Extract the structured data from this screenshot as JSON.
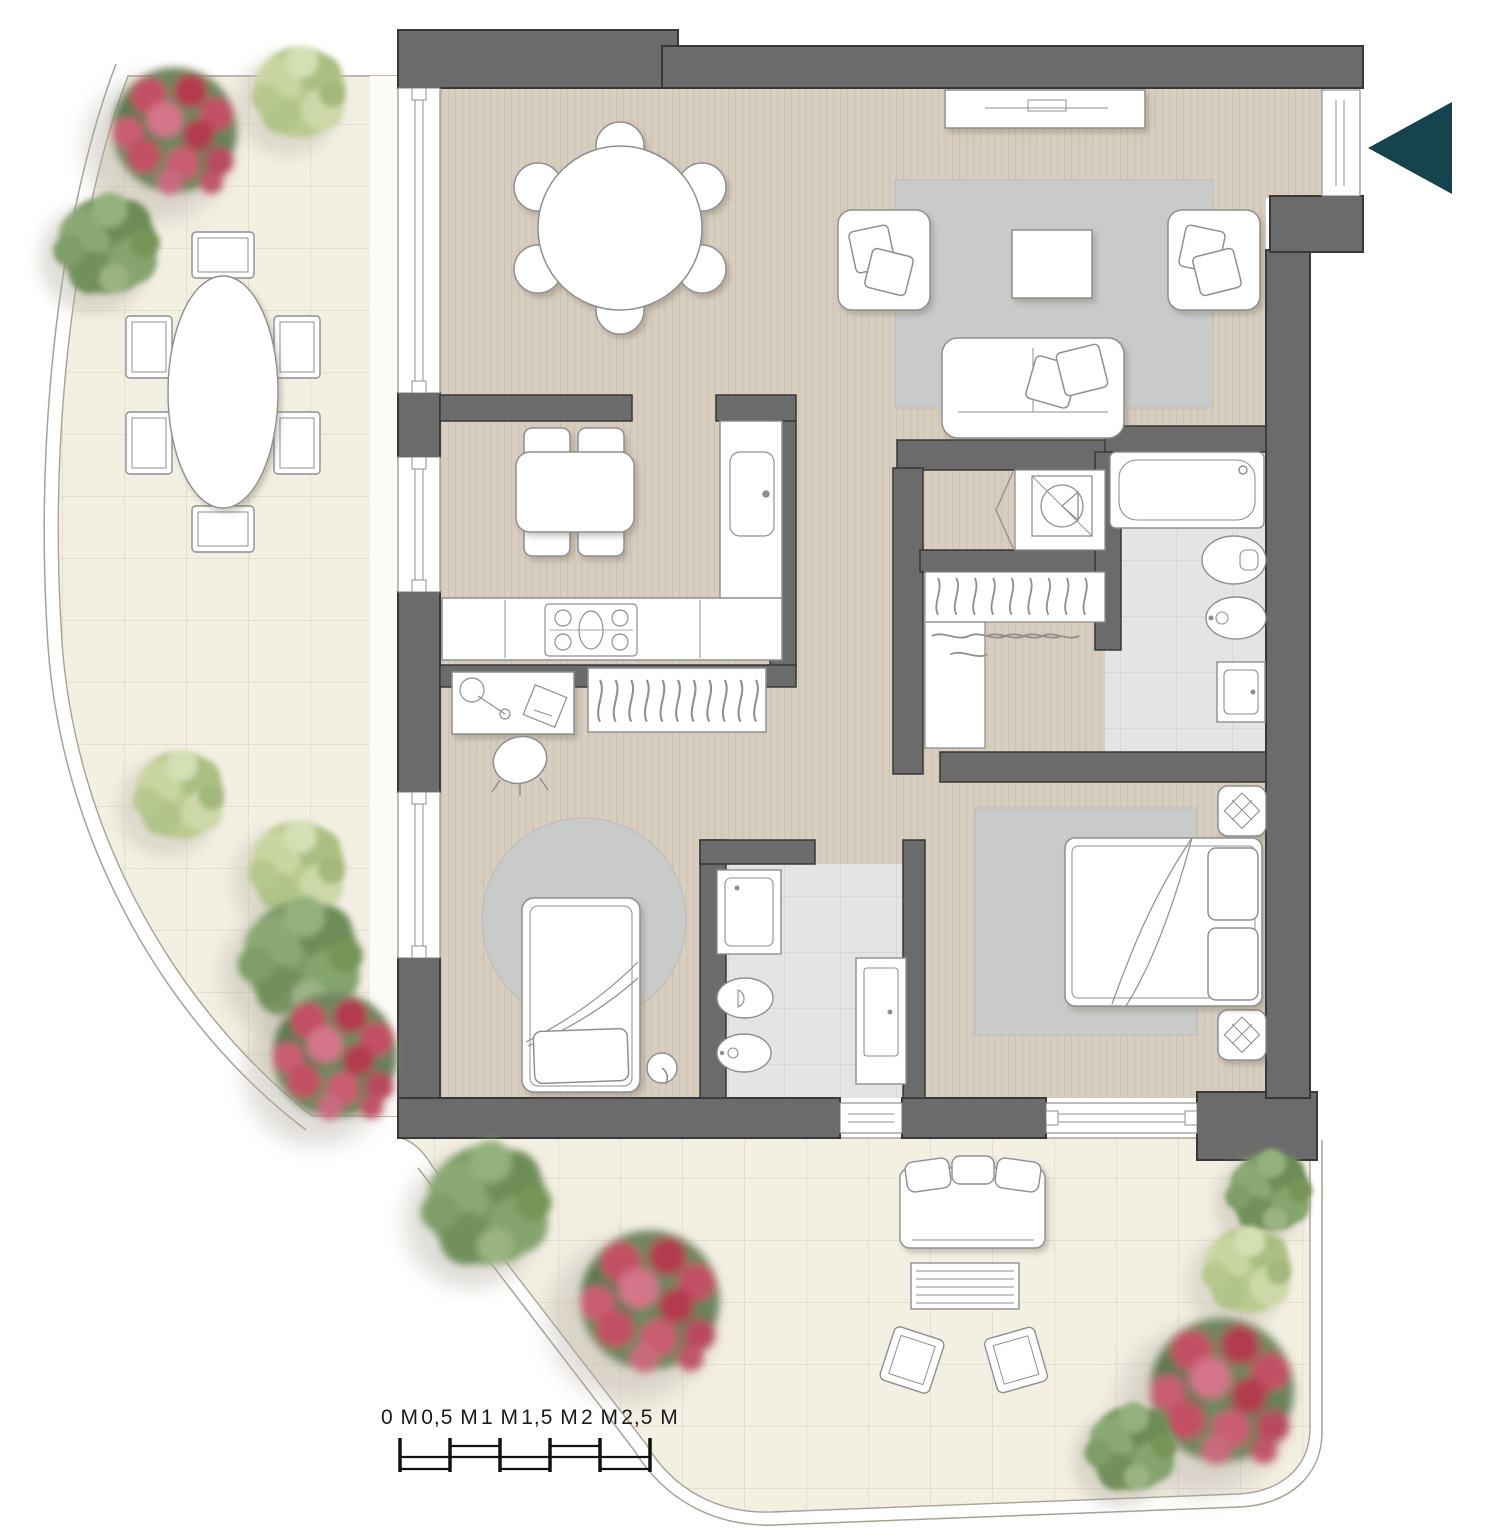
{
  "plan": {
    "type": "apartment-floor-plan",
    "entrance": {
      "arrow_direction": "left"
    },
    "scale_bar": {
      "labels": [
        "0 M",
        "0,5 M",
        "1 M",
        "1,5 M",
        "2 M",
        "2,5 M"
      ],
      "unit": "M",
      "segments": 5
    },
    "colors": {
      "background": "#ffffff",
      "wall": "#6b6b6b",
      "wall_outline": "#383838",
      "wood_floor": "#d8cec0",
      "wood_stripe": "#c6b9a8",
      "terrace_tile": "#f3efe3",
      "terrace_grid": "#ddd6c4",
      "terrace_edge": "#a8a294",
      "bath_tile": "#e4e4e4",
      "bath_grid": "#d2d2d2",
      "rug": "#c8cbc9",
      "furniture_fill": "#ffffff",
      "furniture_stroke": "#8f8f8f",
      "entrance_arrow": "#17434c",
      "plant_green": "#7c9a67",
      "plant_light_green": "#bcca90",
      "plant_red": "#c24f63",
      "scale_text": "#1a1a1a"
    },
    "elements": [
      "exterior-walls",
      "interior-walls",
      "left-wall-windows",
      "bottom-wall-windows",
      "entrance-door",
      "entrance-arrow",
      "wood-floor",
      "curved-terrace",
      "bottom-terrace",
      "round-dining-table-6-chairs",
      "tv-sideboard",
      "living-rug",
      "armchair-left",
      "armchair-right",
      "coffee-table",
      "sofa",
      "kitchen-table-4-chairs",
      "kitchen-counter",
      "kitchen-sink",
      "stove",
      "desk-with-lamp",
      "office-chair",
      "wardrobe-hangers",
      "round-rug",
      "single-bed",
      "floor-lamp",
      "walk-in-closet",
      "washing-machine-closet",
      "bathtub",
      "toilet",
      "bidet",
      "washbasin",
      "shower",
      "double-bed",
      "nightstands",
      "outdoor-oval-table-6-chairs",
      "outdoor-sofa",
      "outdoor-coffee-table",
      "outdoor-chairs",
      "green-bushes",
      "red-flowering-bushes",
      "scale-bar"
    ]
  }
}
